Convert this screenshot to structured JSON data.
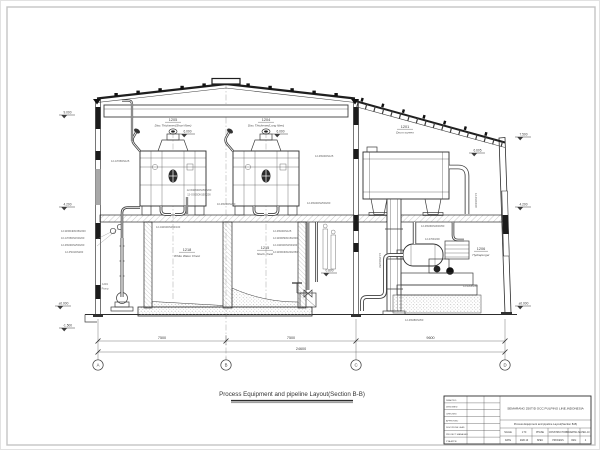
{
  "sheet": {
    "title": "Process Equipment and pipeline Layout(Section B-B)"
  },
  "grid": {
    "bubbles": [
      "A",
      "B",
      "C",
      "D"
    ],
    "dims": [
      "7500",
      "7500",
      "9600"
    ],
    "overall": "24600"
  },
  "equipment": {
    "thickener1": {
      "tag": "1205",
      "name": "Disc Thickener(Short fiber)"
    },
    "thickener2": {
      "tag": "1204",
      "name": "Disc Thickener(Long fiber)"
    },
    "chest1": {
      "tag": "1218",
      "name": "White Water Chest"
    },
    "chest2": {
      "tag": "1215",
      "name": "Stock chest"
    },
    "drum": {
      "tag": "1201",
      "name": "Drum screen"
    },
    "purger": {
      "tag": "1206",
      "name": "Hydrapurger"
    },
    "pump": {
      "tag": "1219",
      "name": "Pump"
    }
  },
  "elevation_flags": [
    {
      "x": 58,
      "y": 114,
      "text": "9.000"
    },
    {
      "x": 58,
      "y": 206,
      "text": "4.200"
    },
    {
      "x": 54,
      "y": 305,
      "text": "±0.000"
    },
    {
      "x": 58,
      "y": 327,
      "text": "-1.500"
    },
    {
      "x": 514,
      "y": 136,
      "text": "7.500"
    },
    {
      "x": 514,
      "y": 206,
      "text": "4.200"
    },
    {
      "x": 514,
      "y": 305,
      "text": "±0.000"
    },
    {
      "x": 178,
      "y": 133,
      "text": "6.000"
    },
    {
      "x": 271,
      "y": 133,
      "text": "6.000"
    },
    {
      "x": 468,
      "y": 152,
      "text": "6.605"
    },
    {
      "x": 320,
      "y": 272,
      "text": "0.800"
    }
  ],
  "pipe_tags": [
    {
      "x": 60,
      "y": 231,
      "text": "12-WW04DN350/200"
    },
    {
      "x": 60,
      "y": 238,
      "text": "10-GT05DN150/200"
    },
    {
      "x": 60,
      "y": 245,
      "text": "12-RS03DN250/200"
    },
    {
      "x": 64,
      "y": 252,
      "text": "12-PS01DN200"
    },
    {
      "x": 104,
      "y": 284,
      "text": "1219",
      "anchor": "middle"
    },
    {
      "x": 104,
      "y": 288.5,
      "text": "Pump",
      "anchor": "middle"
    },
    {
      "x": 110,
      "y": 161,
      "text": "12-GT05DN125"
    },
    {
      "x": 314,
      "y": 156,
      "text": "12-RS04DN125"
    },
    {
      "x": 198,
      "y": 190,
      "text": "12-WW04DN350/200",
      "anchor": "middle"
    },
    {
      "x": 198,
      "y": 194.6,
      "text": "12-GS05DN150/200",
      "anchor": "middle"
    },
    {
      "x": 216,
      "y": 204,
      "text": "10-RS03DN200"
    },
    {
      "x": 306,
      "y": 203,
      "text": "12-RS04DN250/200"
    },
    {
      "x": 155,
      "y": 227,
      "text": "12-GW04DN150/100"
    },
    {
      "x": 272,
      "y": 231,
      "text": "12-RS04DN125"
    },
    {
      "x": 272,
      "y": 238,
      "text": "12-WW05DN150/200"
    },
    {
      "x": 272,
      "y": 245,
      "text": "12-GW02DN150/200"
    },
    {
      "x": 272,
      "y": 252,
      "text": "12-WW03DN200/250"
    },
    {
      "x": 420,
      "y": 226,
      "text": "12-RS06DN300/350"
    },
    {
      "x": 474,
      "y": 192,
      "text": "12-01DN600",
      "rotate": 90
    },
    {
      "x": 378,
      "y": 252,
      "text": "12-05DN250",
      "rotate": 90
    },
    {
      "x": 462,
      "y": 286,
      "text": "12-02DN250"
    },
    {
      "x": 404,
      "y": 320,
      "text": "12-RS08DN350"
    },
    {
      "x": 424,
      "y": 239,
      "text": "12-07DN200"
    }
  ],
  "title_block": {
    "rows": [
      "DRAFTED",
      "DESIGNED",
      "CHECKED",
      "APPROVED",
      "DISCIPLINE LEAD",
      "PROJECT MANAGER",
      "PTA APPR."
    ],
    "project": "SEMARANG 250T/D OCC PULPING LINE,INDONESIA",
    "drawing_title": "Process Equipment and pipeline Layout(Section B-B)",
    "cells_row1": [
      "SCALE",
      "1:70",
      "PHASE",
      "CONSTRUCTION",
      "DRAWING No.",
      "PEC-10"
    ],
    "cells_row2": [
      "DATE",
      "2020.10",
      "SPEC",
      "PROCESS",
      "REV.",
      "4"
    ]
  },
  "colors": {
    "line": "#3d3d3d",
    "light": "#9a9a9a",
    "paper": "#ffffff"
  }
}
